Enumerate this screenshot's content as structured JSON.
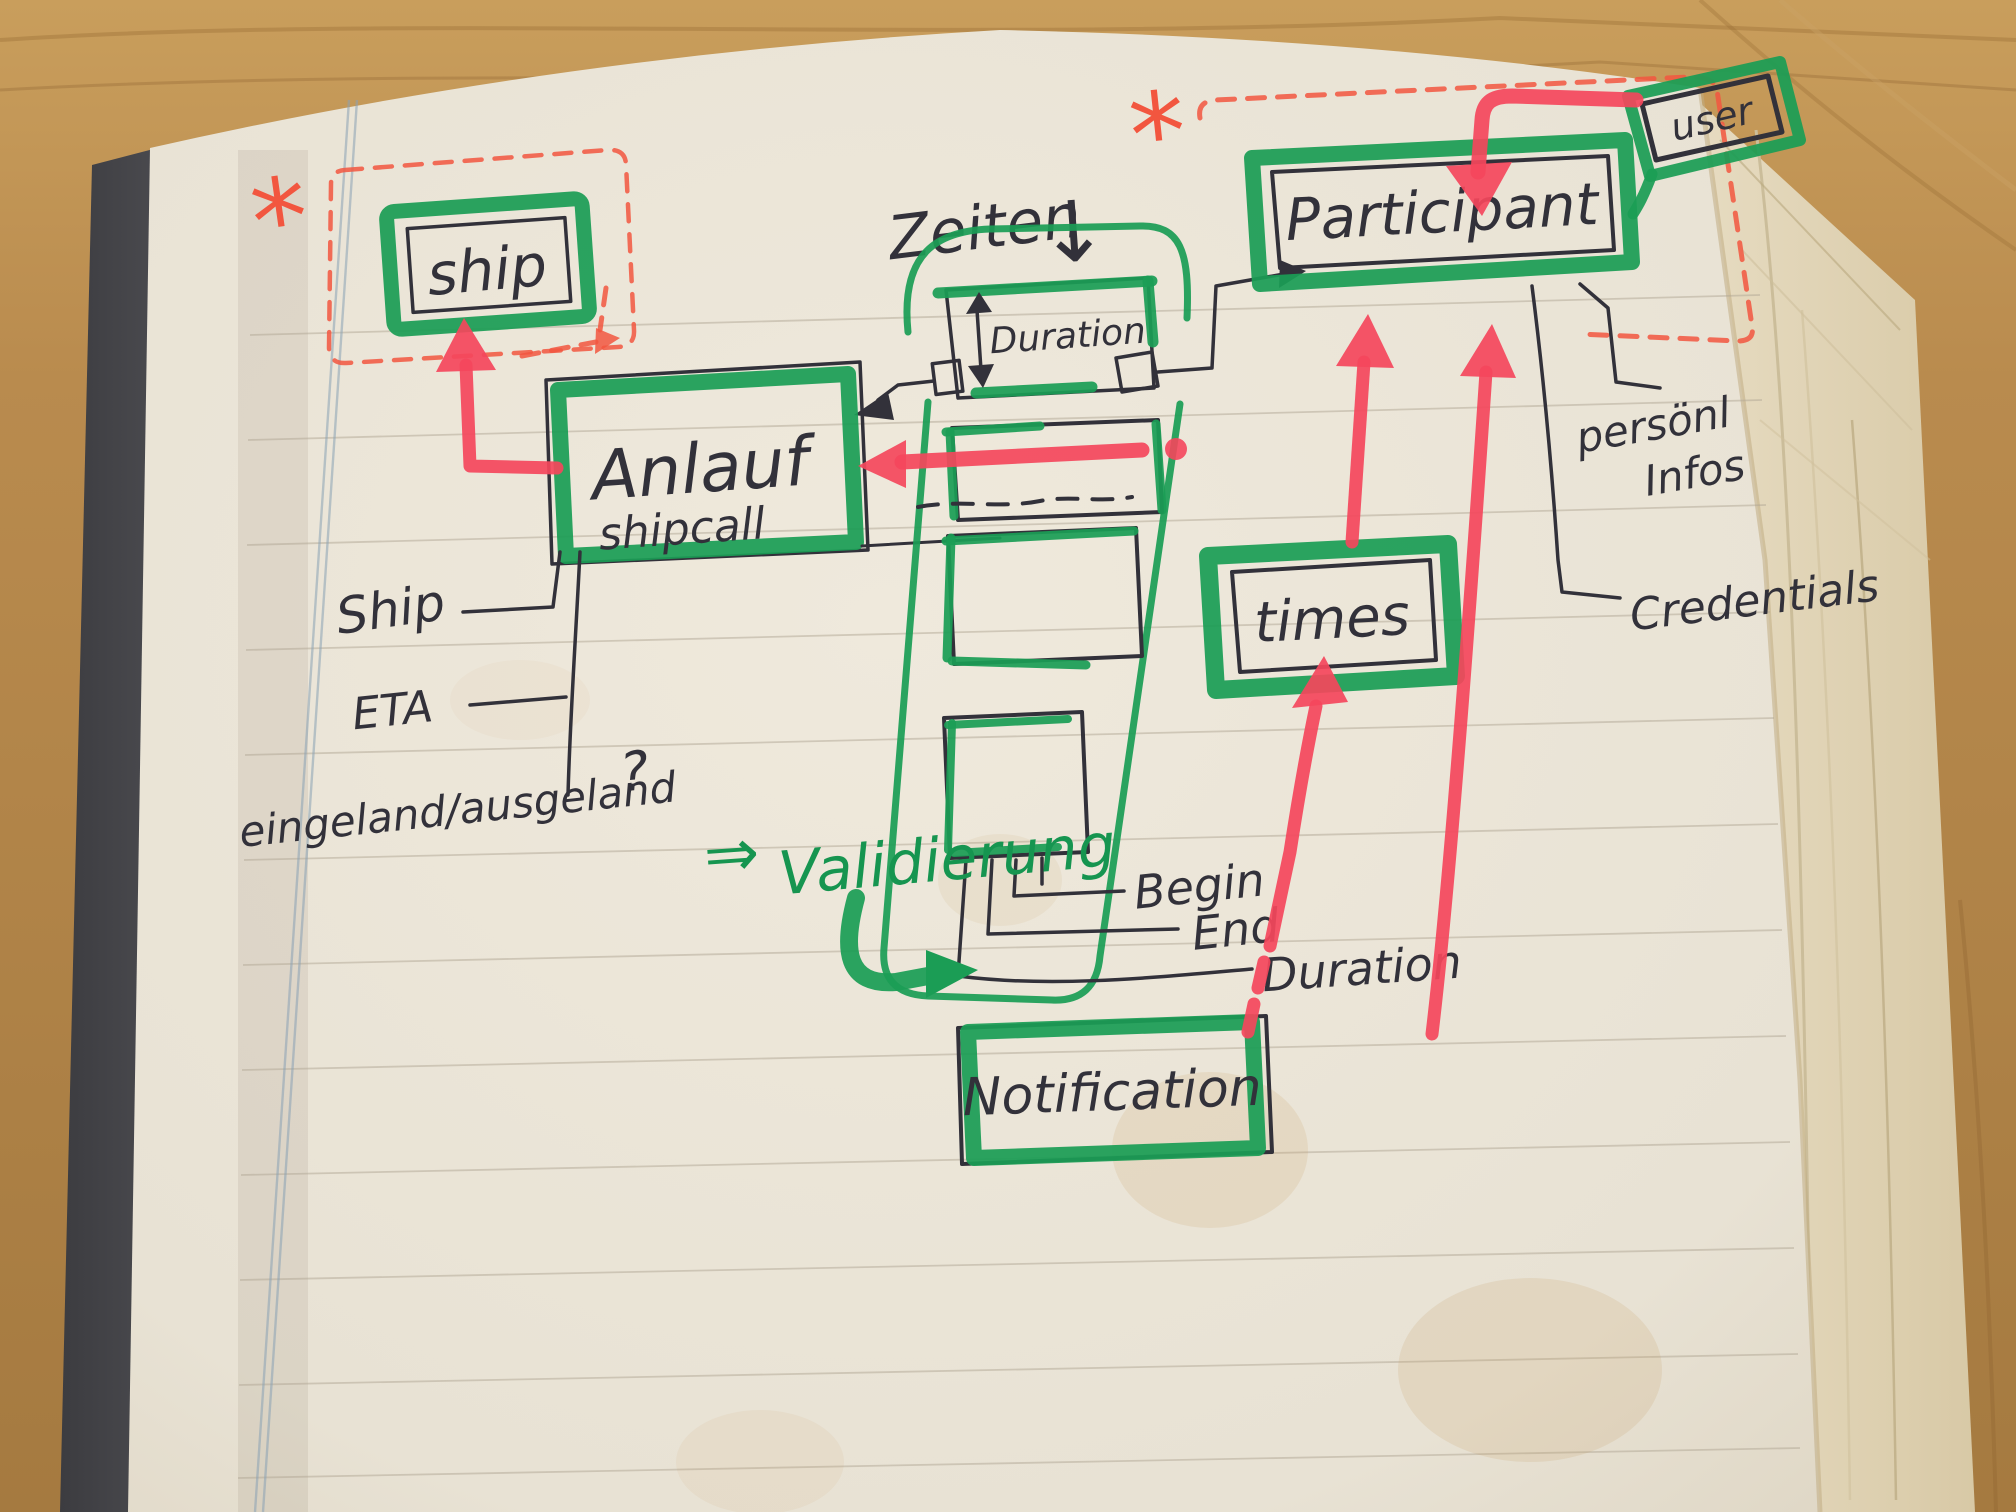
{
  "photo": {
    "colors": {
      "wood": "#b98b4e",
      "page": "#eae4d8",
      "page_edge": "#e2d5ba",
      "cover": "#47474b",
      "ink": "#32313a",
      "marker_green": "#1b9d55",
      "marker_red": "#f4465c",
      "dashed_red": "#f2563f",
      "margin_blue": "#8aa2b5"
    },
    "entities": {
      "ship": "ship",
      "anlauf": "Anlauf",
      "anlauf_sub": "shipcall",
      "duration_box": "Duration",
      "participant": "Participant",
      "user": "user",
      "times": "times",
      "notification": "Notification"
    },
    "labels": {
      "zeiten": "Zeiten",
      "zeiten_arrow": "↓",
      "ship_attr": "Ship",
      "eta": "ETA",
      "inout": "eingeland/ausgeland",
      "question_mark": "?",
      "personal_line1": "persönl",
      "personal_line2": "Infos",
      "credentials": "Credentials",
      "begin": "Begin",
      "end": "End",
      "duration": "Duration",
      "validierung_arrow": "⇒",
      "validierung": "Validierung",
      "asterisk_left": "*",
      "asterisk_right": "*"
    }
  }
}
